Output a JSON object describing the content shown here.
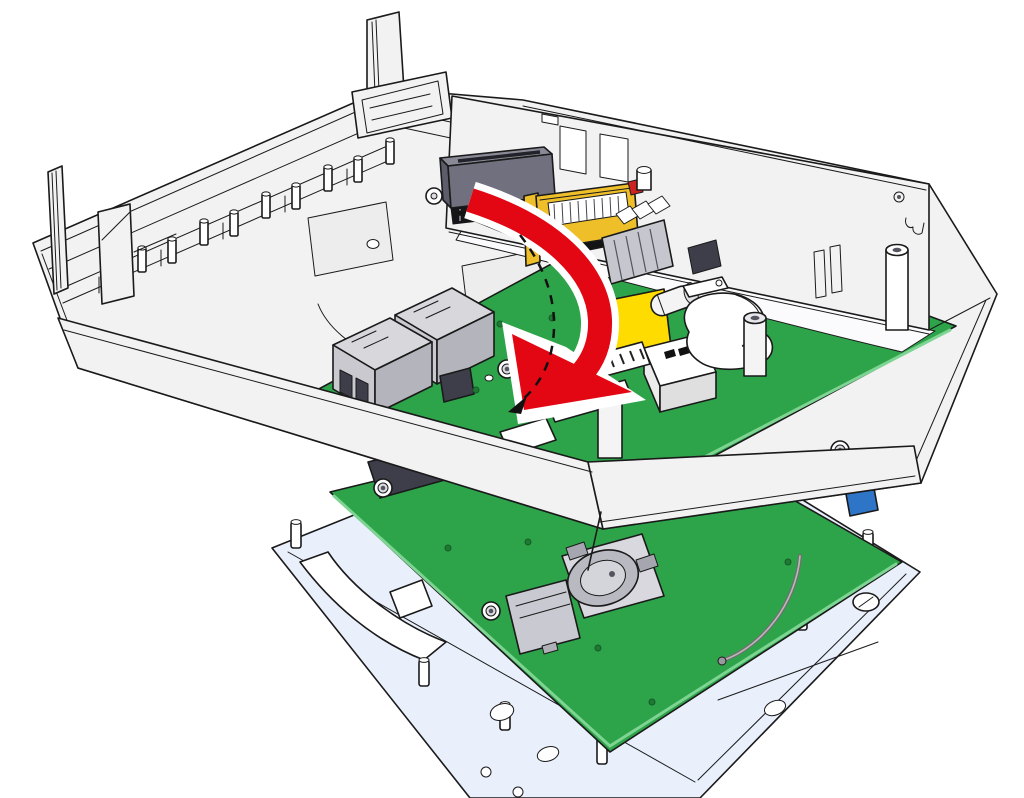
{
  "page": {
    "background": "#ffffff"
  },
  "illustration": {
    "alt": "Assembly step diagram: the controller circuit board inside the housing bottom shell is rotated down (red arrow with dashed guide arc) onto the backplane connectors above the display unit with its display circuit board and frame.",
    "colors": {
      "outline": "#1a1a1a",
      "shell": "#f2f2f2",
      "shell_bright": "#fbfbfd",
      "tray": "#e9effb",
      "pcb": "#2ea44a",
      "pcb_edge": "#7ed492",
      "arrow_red": "#e30613",
      "connector_orange": "#efbf2a",
      "connector_slate": "#70707e",
      "component_yellow": "#ffdc00",
      "component_blue": "#2e75c8",
      "metal_gray": "#c9c9cf",
      "dark_component": "#3e3e4a",
      "wire_gray": "#8a8a8a",
      "white": "#ffffff"
    },
    "parts": [
      "upper-housing-shell",
      "din-latch-tab-left",
      "din-latch-tab-top",
      "backplane-socket",
      "card-edge-connector",
      "ribbon-band",
      "controller-pcb",
      "ethernet-jack",
      "terminal-block",
      "relay",
      "capacitor",
      "buzzer",
      "yellow-component",
      "ffc-connector",
      "pcb-standoff",
      "rotation-arrow",
      "rotation-guide",
      "display-frame",
      "display-pcb",
      "coin-cell-holder",
      "microsd-slot",
      "antenna-wire",
      "blue-trimmer",
      "mounting-screw"
    ]
  }
}
